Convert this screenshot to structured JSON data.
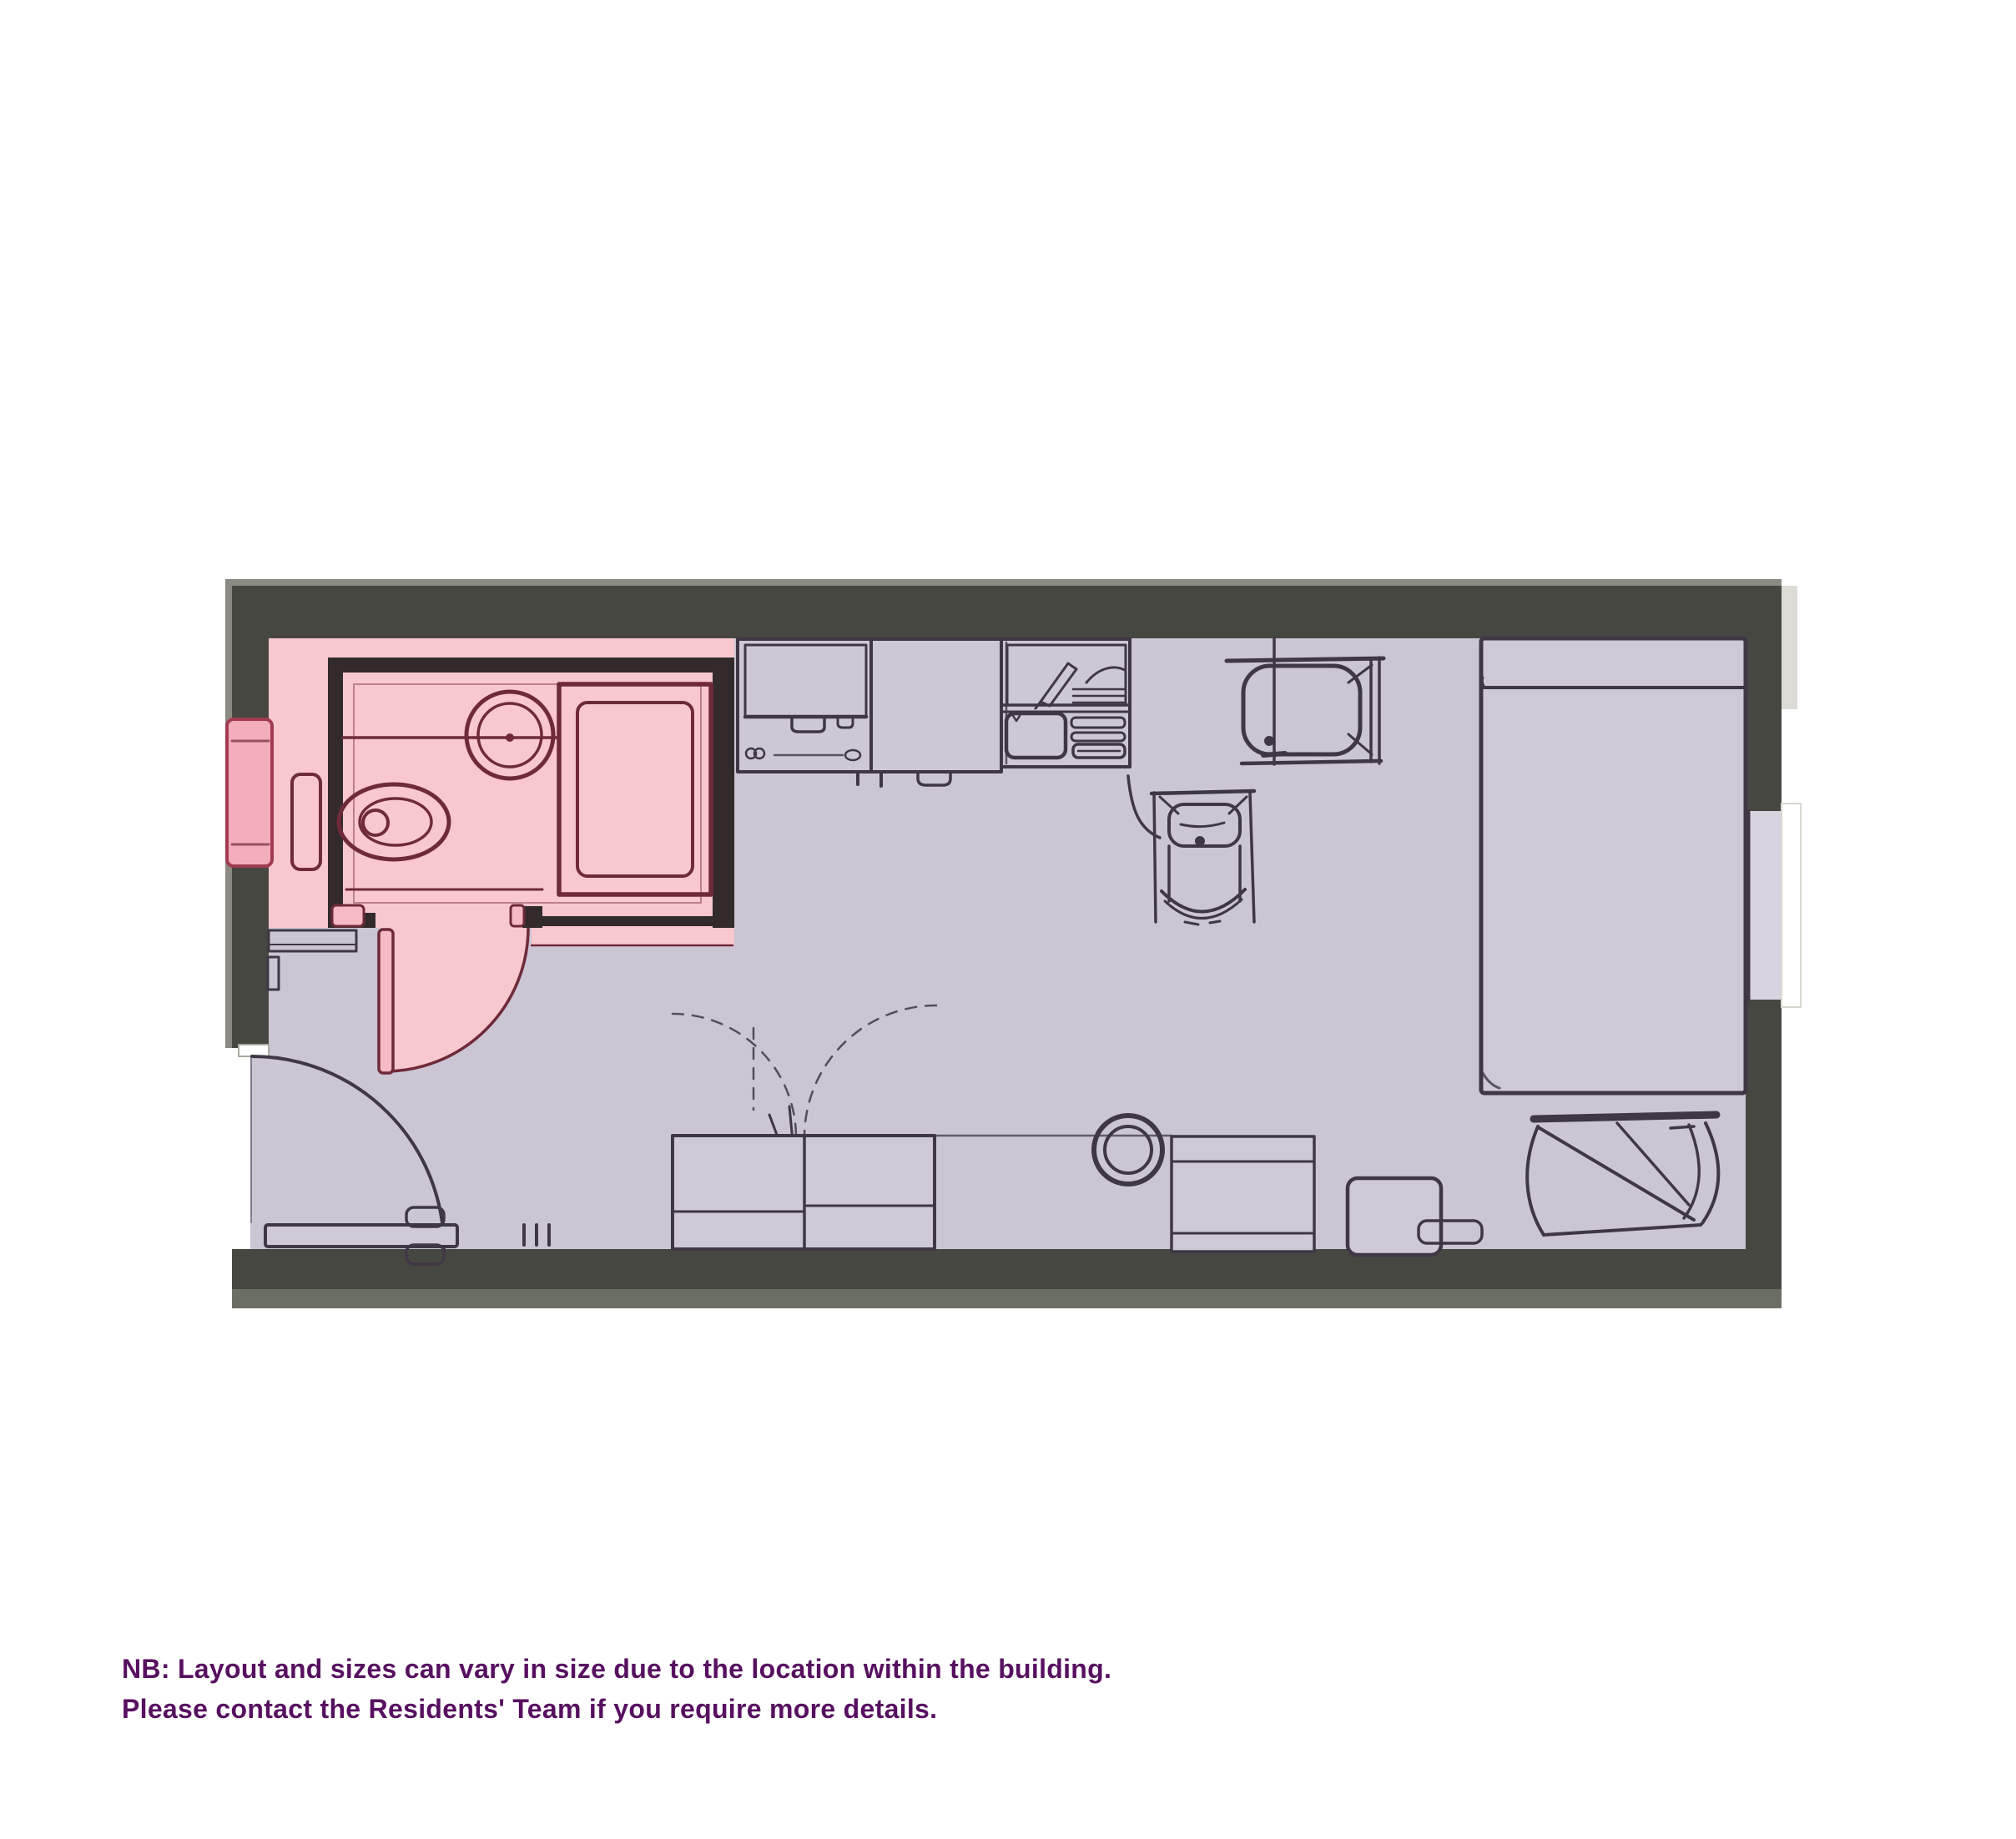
{
  "caption": {
    "line1": "NB: Layout and sizes can vary in size due to the location within the building.",
    "line2": "Please contact the Residents' Team if you require more details."
  },
  "colors": {
    "canvas": "#ffffff",
    "wall": "#474741",
    "wall_outer": "#8b8b83",
    "wall_bottom_outer": "#6b6e63",
    "wall_pale": "#dcdbd5",
    "floor": "#cbc5d4",
    "floor_light": "#cfc9d7",
    "counter": "#cdc7d6",
    "bath_floor": "#f9c7ce",
    "bath_wall": "#332a2c",
    "bath_line": "#6f2a3a",
    "bath_door": "#f6bac4",
    "bath_window": "#f4aebb",
    "bath_window_line": "#a13c50",
    "furniture_line": "#3f3746",
    "window_sill": "#d9d3df",
    "caption_text": "#571060"
  },
  "plan": {
    "rooms": [
      "studio",
      "bathroom"
    ],
    "fixtures": [
      "toilet",
      "washbasin",
      "shower",
      "kitchen-counter",
      "sink-drainer",
      "table",
      "chair",
      "bed",
      "armchair",
      "wardrobe",
      "round-side-table",
      "cabinet",
      "storage-box",
      "entrance-door",
      "bathroom-door",
      "bathroom-window",
      "bedroom-window"
    ]
  }
}
